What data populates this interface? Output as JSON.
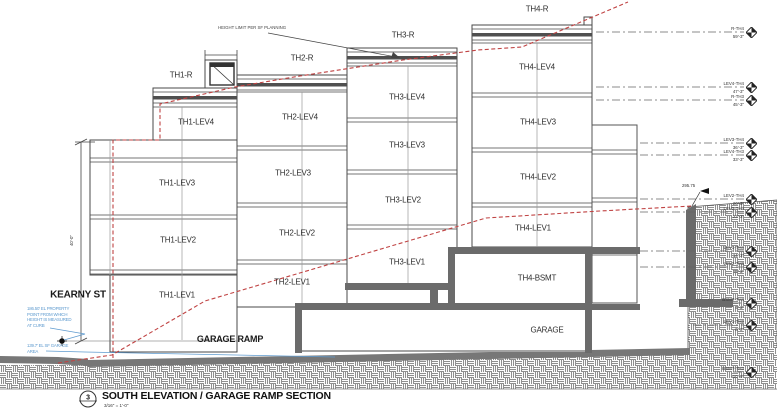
{
  "title_block": {
    "number": "3",
    "title": "SOUTH ELEVATION / GARAGE RAMP SECTION",
    "scale": "3/16\" = 1'-0\""
  },
  "street": {
    "label": "KEARNY ST"
  },
  "ramp": {
    "label": "GARAGE RAMP"
  },
  "garage": {
    "label": "GARAGE"
  },
  "notes": {
    "height_limit": "HEIGHT LIMIT PER SF PLANNING",
    "curb_note_lines": [
      "186.50' EL PROPERTY",
      "POINT FROM WHICH",
      "HEIGHT IS MEASURED",
      "AT CURB"
    ],
    "garage_area_note_lines": [
      "139.7' EL SF GARAGE",
      "AREA"
    ],
    "wall_spot_elevation": "295.75"
  },
  "dimensions": {
    "street_height": "40'-0\""
  },
  "units": [
    {
      "id": "TH1",
      "roof_label": "TH1-R",
      "levels": [
        "TH1-LEV4",
        "TH1-LEV3",
        "TH1-LEV2",
        "TH1-LEV1"
      ]
    },
    {
      "id": "TH2",
      "roof_label": "TH2-R",
      "levels": [
        "TH2-LEV4",
        "TH2-LEV3",
        "TH2-LEV2",
        "TH2-LEV1"
      ]
    },
    {
      "id": "TH3",
      "roof_label": "TH3-R",
      "levels": [
        "TH3-LEV4",
        "TH3-LEV3",
        "TH3-LEV2",
        "TH3-LEV1"
      ]
    },
    {
      "id": "TH4",
      "roof_label": "TH4-R",
      "levels": [
        "TH4-LEV4",
        "TH4-LEV3",
        "TH4-LEV2",
        "TH4-LEV1"
      ],
      "basement_label": "TH4-BSMT"
    }
  ],
  "level_markers": [
    {
      "name": "R-TH4",
      "elevation": "59'-3\""
    },
    {
      "name": "LEV4-TH4",
      "elevation": "47'-3\""
    },
    {
      "name": "R-TH3",
      "elevation": "45'-3\""
    },
    {
      "name": "LEV3-TH4",
      "elevation": "36'-3\""
    },
    {
      "name": "LEV4-TH3",
      "elevation": "33'-3\""
    },
    {
      "name": "LEV2-TH4",
      "elevation": "26'-3\""
    },
    {
      "name": "LEV3-TH3",
      "elevation": "23'-3\""
    },
    {
      "name": "LEV1-TH4",
      "elevation": "14'-3\""
    },
    {
      "name": "LEV2-TH3",
      "elevation": "11'-3\""
    },
    {
      "name": "BSMT-TH4",
      "elevation": "4'-3\""
    },
    {
      "name": "LEV1-TH3",
      "elevation": "0'-0\""
    },
    {
      "name": "BSMT-TH3",
      "elevation": "-10'-9\""
    }
  ],
  "colors": {
    "height_limit_red": "#c04343",
    "note_blue": "#5f9bcf",
    "structure_gray": "#6b6b6b",
    "hatch_line_gray": "#8f8f8f"
  }
}
